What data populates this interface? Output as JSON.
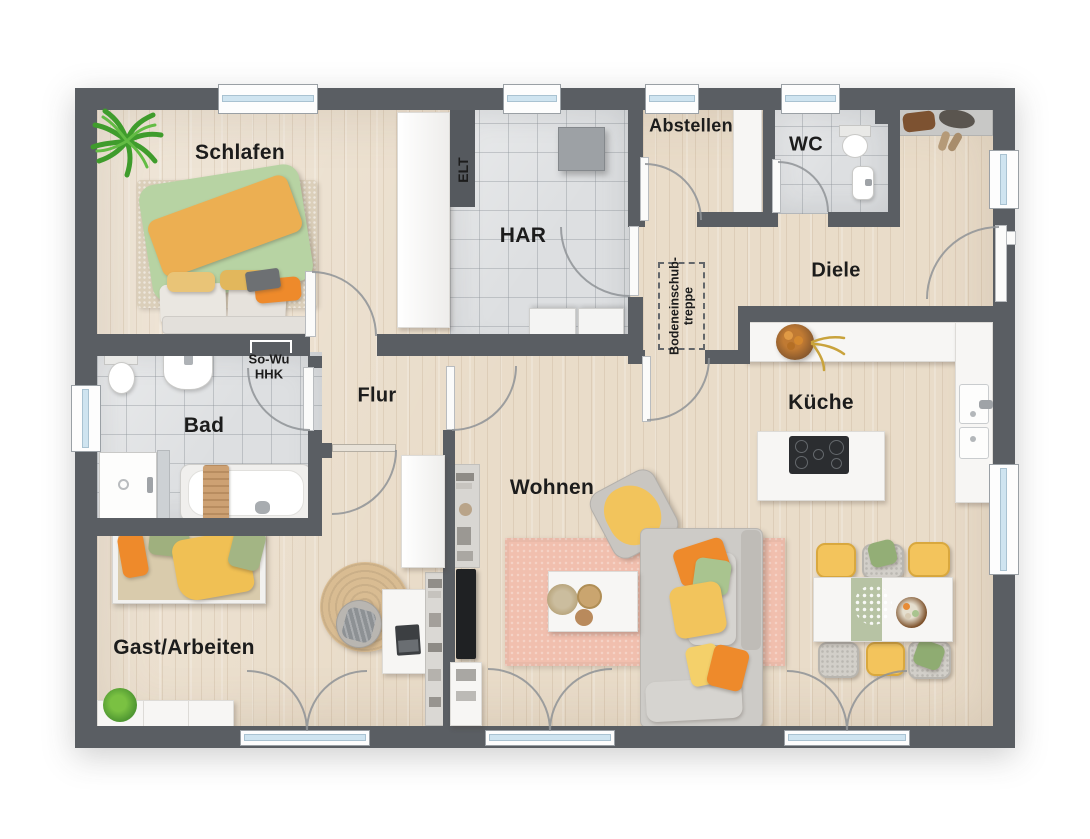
{
  "plan": {
    "rooms": {
      "schlafen": {
        "label": "Schlafen"
      },
      "har": {
        "label": "HAR"
      },
      "abstellen": {
        "label": "Abstellen"
      },
      "wc": {
        "label": "WC"
      },
      "diele": {
        "label": "Diele"
      },
      "kueche": {
        "label": "Küche"
      },
      "flur": {
        "label": "Flur"
      },
      "bad": {
        "label": "Bad"
      },
      "wohnen": {
        "label": "Wohnen"
      },
      "gast_arbeiten": {
        "label": "Gast/Arbeiten"
      }
    },
    "annotations": {
      "elt": {
        "label": "ELT"
      },
      "so_wu_hhk": {
        "line1": "So-Wu",
        "line2": "HHK"
      },
      "bodeneinschubtreppe": {
        "line1": "Bodeneinschub-",
        "line2": "treppe"
      }
    },
    "colors": {
      "wall": "#5a5e63",
      "floor_wood": "#e9dcc9",
      "floor_tile": "#dddfe1",
      "rug_pink": "#f1bfae",
      "rug_jute": "#d9bc92",
      "accent_orange": "#ee8a2b",
      "accent_yellow": "#f2c45c",
      "accent_green": "#a9c48f",
      "runner_sage": "#b7c3a4",
      "glass_blue": "#cfe4f0"
    }
  }
}
